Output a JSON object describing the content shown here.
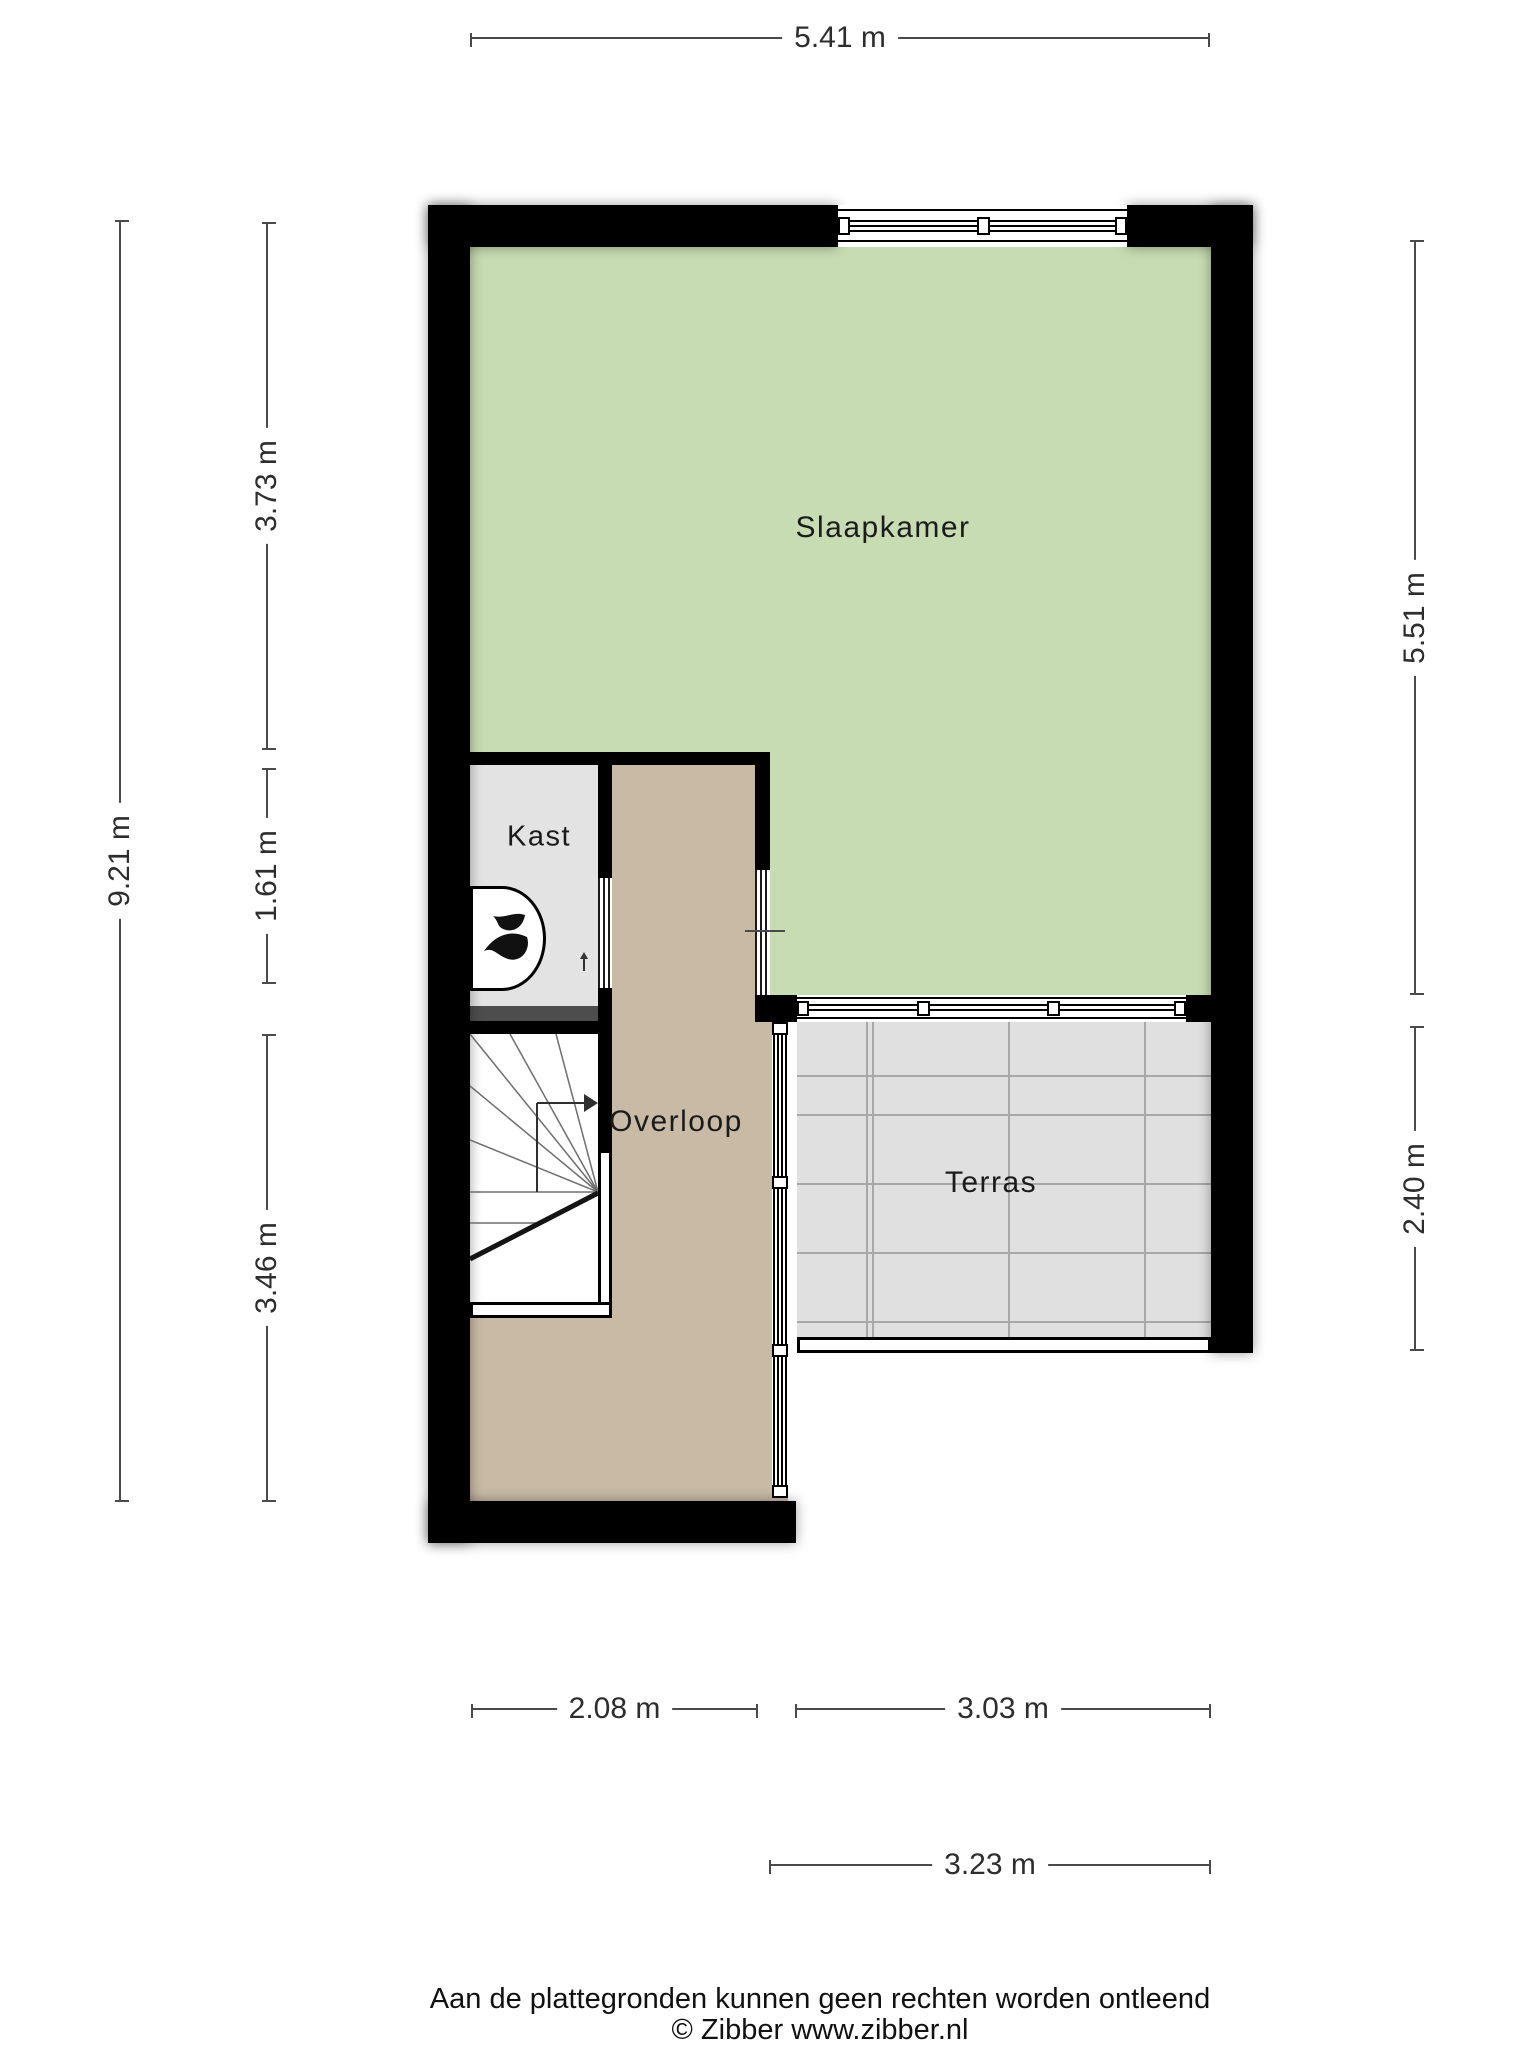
{
  "rooms": {
    "slaapkamer": {
      "label": "Slaapkamer",
      "floor_color": "#c8dcb3"
    },
    "kast": {
      "label": "Kast",
      "floor_color": "#e3e3e3"
    },
    "overloop": {
      "label": "Overloop",
      "floor_color": "#c8baa5"
    },
    "terras": {
      "label": "Terras",
      "floor_color": "#e0e0e0"
    }
  },
  "dimensions": {
    "top_width": "5.41 m",
    "left_total_height": "9.21 m",
    "left_upper": "3.73 m",
    "left_middle": "1.61 m",
    "left_lower": "3.46 m",
    "right_upper": "5.51 m",
    "right_lower": "2.40 m",
    "bottom_overloop": "2.08 m",
    "bottom_terras_inner": "3.03 m",
    "bottom_terras_outer": "3.23 m"
  },
  "icons": {
    "heater_flame": "flame-icon",
    "stair_direction": "arrow-right-icon",
    "door_swing": "arrow-up-icon"
  },
  "colors": {
    "wall": "#000000",
    "slaapkamer_floor": "#c8dcb3",
    "overloop_floor": "#c8baa5",
    "kast_floor": "#e3e3e3",
    "terras_floor": "#e0e0e0",
    "tile_line": "#a8a8a8",
    "under_stair_divider": "#4d4d4d",
    "dimension_line": "#4a4a4a",
    "background": "#ffffff"
  },
  "footer": {
    "disclaimer": "Aan de plattegronden kunnen geen rechten worden ontleend",
    "credit": "© Zibber www.zibber.nl"
  }
}
